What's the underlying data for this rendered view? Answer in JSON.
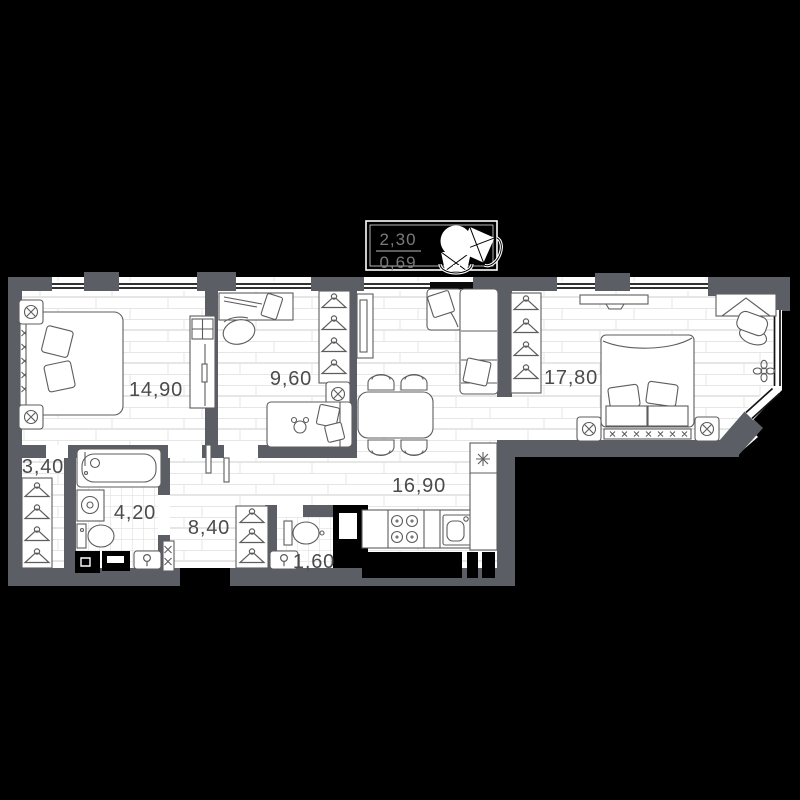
{
  "balcony": {
    "value_top": "2,30",
    "value_bottom": "0,69"
  },
  "rooms": [
    {
      "id": "bedroom-1",
      "area": "14,90"
    },
    {
      "id": "kids-room",
      "area": "9,60"
    },
    {
      "id": "bedroom-2",
      "area": "17,80"
    },
    {
      "id": "walk-in-closet",
      "area": "3,40"
    },
    {
      "id": "bathroom",
      "area": "4,20"
    },
    {
      "id": "hallway",
      "area": "8,40"
    },
    {
      "id": "kitchen-living-room",
      "area": "16,90"
    },
    {
      "id": "wc",
      "area": "1,60"
    }
  ],
  "colors": {
    "background": "#000000",
    "wall": "#5b5f65",
    "floor": "#ffffff",
    "room_label": "#4b4b4b",
    "balcony_label": "#7a7a7a"
  }
}
